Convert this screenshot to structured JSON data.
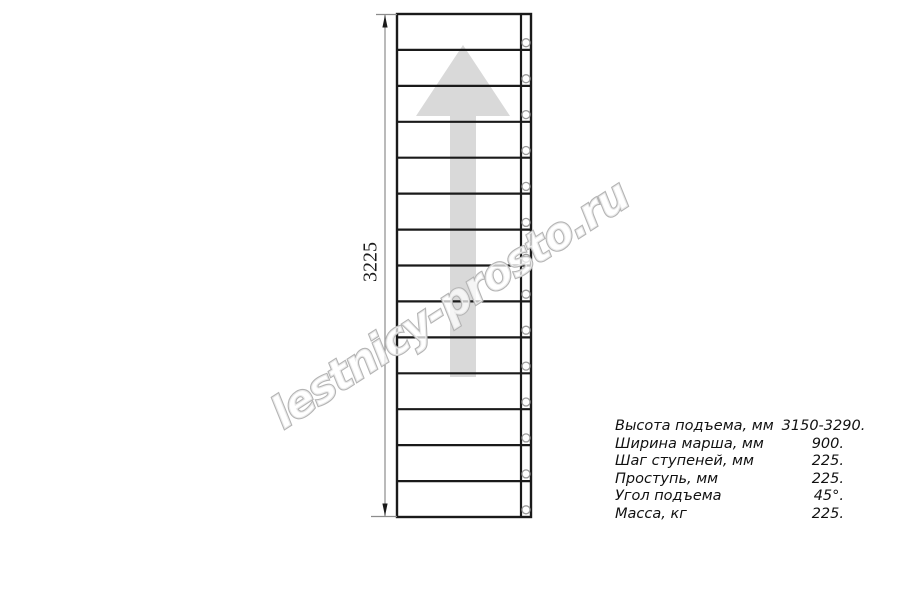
{
  "drawing": {
    "type": "stair-flight-top-view",
    "dimension_label": "3225",
    "watermark_text": "lestnicy-prosto.ru",
    "step_count": 14,
    "baluster_count": 14,
    "direction_arrow": "up",
    "colors": {
      "outline": "#1a1a1a",
      "dimension": "#8c8c8c",
      "arrow_fill": "#d9d9d9",
      "watermark_stroke": "#b4b4b4",
      "baluster_stroke": "#9b9b9b"
    }
  },
  "specs": {
    "rows": [
      {
        "label": "Высота подъема, мм",
        "value": "3150-3290."
      },
      {
        "label": "Ширина марша, мм",
        "value": "900."
      },
      {
        "label": "Шаг ступеней, мм",
        "value": "225."
      },
      {
        "label": "Проступь, мм",
        "value": "225."
      },
      {
        "label": "Угол подъема",
        "value": "45°."
      },
      {
        "label": "Масса, кг",
        "value": "225."
      }
    ]
  }
}
